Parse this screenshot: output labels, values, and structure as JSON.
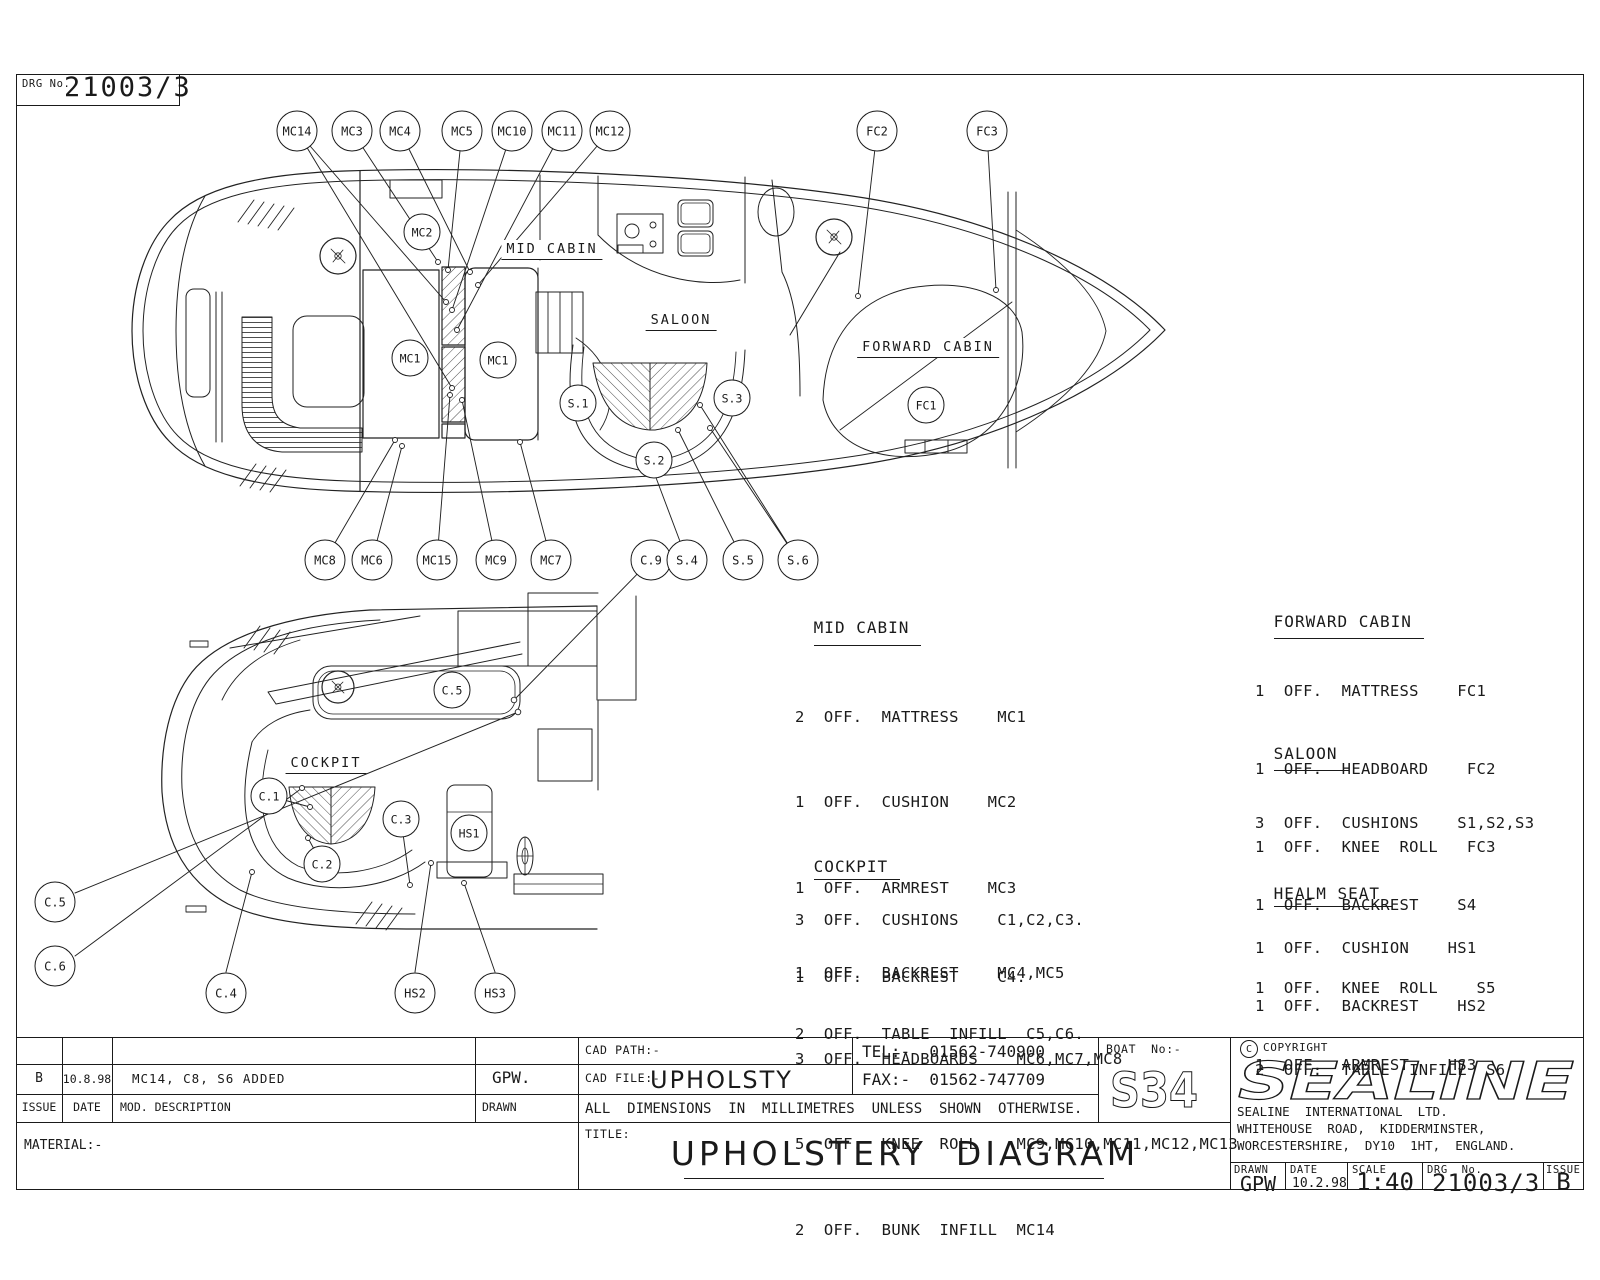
{
  "drg_box": {
    "label": "DRG No.",
    "value": "21003/3"
  },
  "areas": {
    "mid_cabin": "MID CABIN",
    "saloon": "SALOON",
    "forward_cabin": "FORWARD CABIN",
    "cockpit": "COCKPIT"
  },
  "callouts": {
    "mc14": "MC14",
    "mc3": "MC3",
    "mc4": "MC4",
    "mc5": "MC5",
    "mc10": "MC10",
    "mc11": "MC11",
    "mc12": "MC12",
    "fc2": "FC2",
    "fc3": "FC3",
    "mc8": "MC8",
    "mc6": "MC6",
    "mc15": "MC15",
    "mc9": "MC9",
    "mc7": "MC7",
    "c9": "C.9",
    "s4": "S.4",
    "s5": "S.5",
    "s6": "S.6",
    "mc2": "MC2",
    "mc1": "MC1",
    "s1": "S.1",
    "s2": "S.2",
    "s3": "S.3",
    "fc1": "FC1",
    "c1": "C.1",
    "c2": "C.2",
    "c3": "C.3",
    "c5": "C.5",
    "c6": "C.6",
    "c4": "C.4",
    "hs1": "HS1",
    "hs2": "HS2",
    "hs3": "HS3"
  },
  "parts_lists": {
    "mid_cabin": {
      "title": "MID CABIN",
      "items": [
        "2  OFF.  MATTRESS    MC1",
        "1  OFF.  CUSHION    MC2",
        "1  OFF.  ARMREST    MC3",
        "1  OFF.  BACKREST    MC4,MC5",
        "3  OFF.  HEADBOARDS    MC6,MC7,MC8",
        "5  OFF.  KNEE  ROLL    MC9,MC10,MC11,MC12,MC13",
        "2  OFF.  BUNK  INFILL  MC14"
      ]
    },
    "cockpit": {
      "title": "COCKPIT",
      "items": [
        "3  OFF.  CUSHIONS    C1,C2,C3.",
        "1  OFF.  BACKREST    C4.",
        "2  OFF.  TABLE  INFILL  C5,C6."
      ]
    },
    "forward_cabin": {
      "title": "FORWARD CABIN",
      "items": [
        "1  OFF.  MATTRESS    FC1",
        "1  OFF.  HEADBOARD    FC2",
        "1  OFF.  KNEE  ROLL   FC3"
      ]
    },
    "saloon": {
      "title": "SALOON",
      "items": [
        "3  OFF.  CUSHIONS    S1,S2,S3",
        "1  OFF.  BACKREST    S4",
        "1  OFF.  KNEE  ROLL    S5",
        "2  OFF.  TABLE  INFILL  S6"
      ]
    },
    "healm_seat": {
      "title": "HEALM SEAT",
      "items": [
        "1  OFF.  CUSHION    HS1",
        "1  OFF.  BACKREST    HS2",
        "1  OFF.  ARMREST    HS3"
      ]
    }
  },
  "title_block": {
    "revision_row": {
      "issue": "B",
      "date": "10.8.98",
      "description": "MC14, C8, S6 ADDED",
      "drawn": "GPW."
    },
    "header_row": {
      "issue": "ISSUE",
      "date": "DATE",
      "description": "MOD. DESCRIPTION",
      "drawn": "DRAWN"
    },
    "material_label": "MATERIAL:-",
    "cad_path_label": "CAD PATH:-",
    "cad_file_label": "CAD FILE:-",
    "cad_file_value": "UPHOLSTY",
    "tel": "TEL:-  01562-740900",
    "fax": "FAX:-  01562-747709",
    "boat_no_label": "BOAT  No:-",
    "boat_no_value": "S34",
    "dimensions_note": "ALL  DIMENSIONS  IN  MILLIMETRES  UNLESS  SHOWN  OTHERWISE.",
    "title_label": "TITLE:",
    "title": "UPHOLSTERY  DIAGRAM",
    "copyright_symbol": "C",
    "copyright": "COPYRIGHT",
    "brand": "SEALINE",
    "company_line1": "SEALINE  INTERNATIONAL  LTD.",
    "company_line2": "WHITEHOUSE  ROAD,  KIDDERMINSTER,",
    "company_line3": "WORCESTERSHIRE,  DY10  1HT,  ENGLAND.",
    "drawn_label": "DRAWN",
    "drawn_value": "GPW",
    "date_label": "DATE",
    "date_value": "10.2.98",
    "scale_label": "SCALE",
    "scale_value": "1:40",
    "drg_label": "DRG  No.",
    "drg_value": "21003/3",
    "issue_label": "ISSUE",
    "issue_value": "B"
  }
}
